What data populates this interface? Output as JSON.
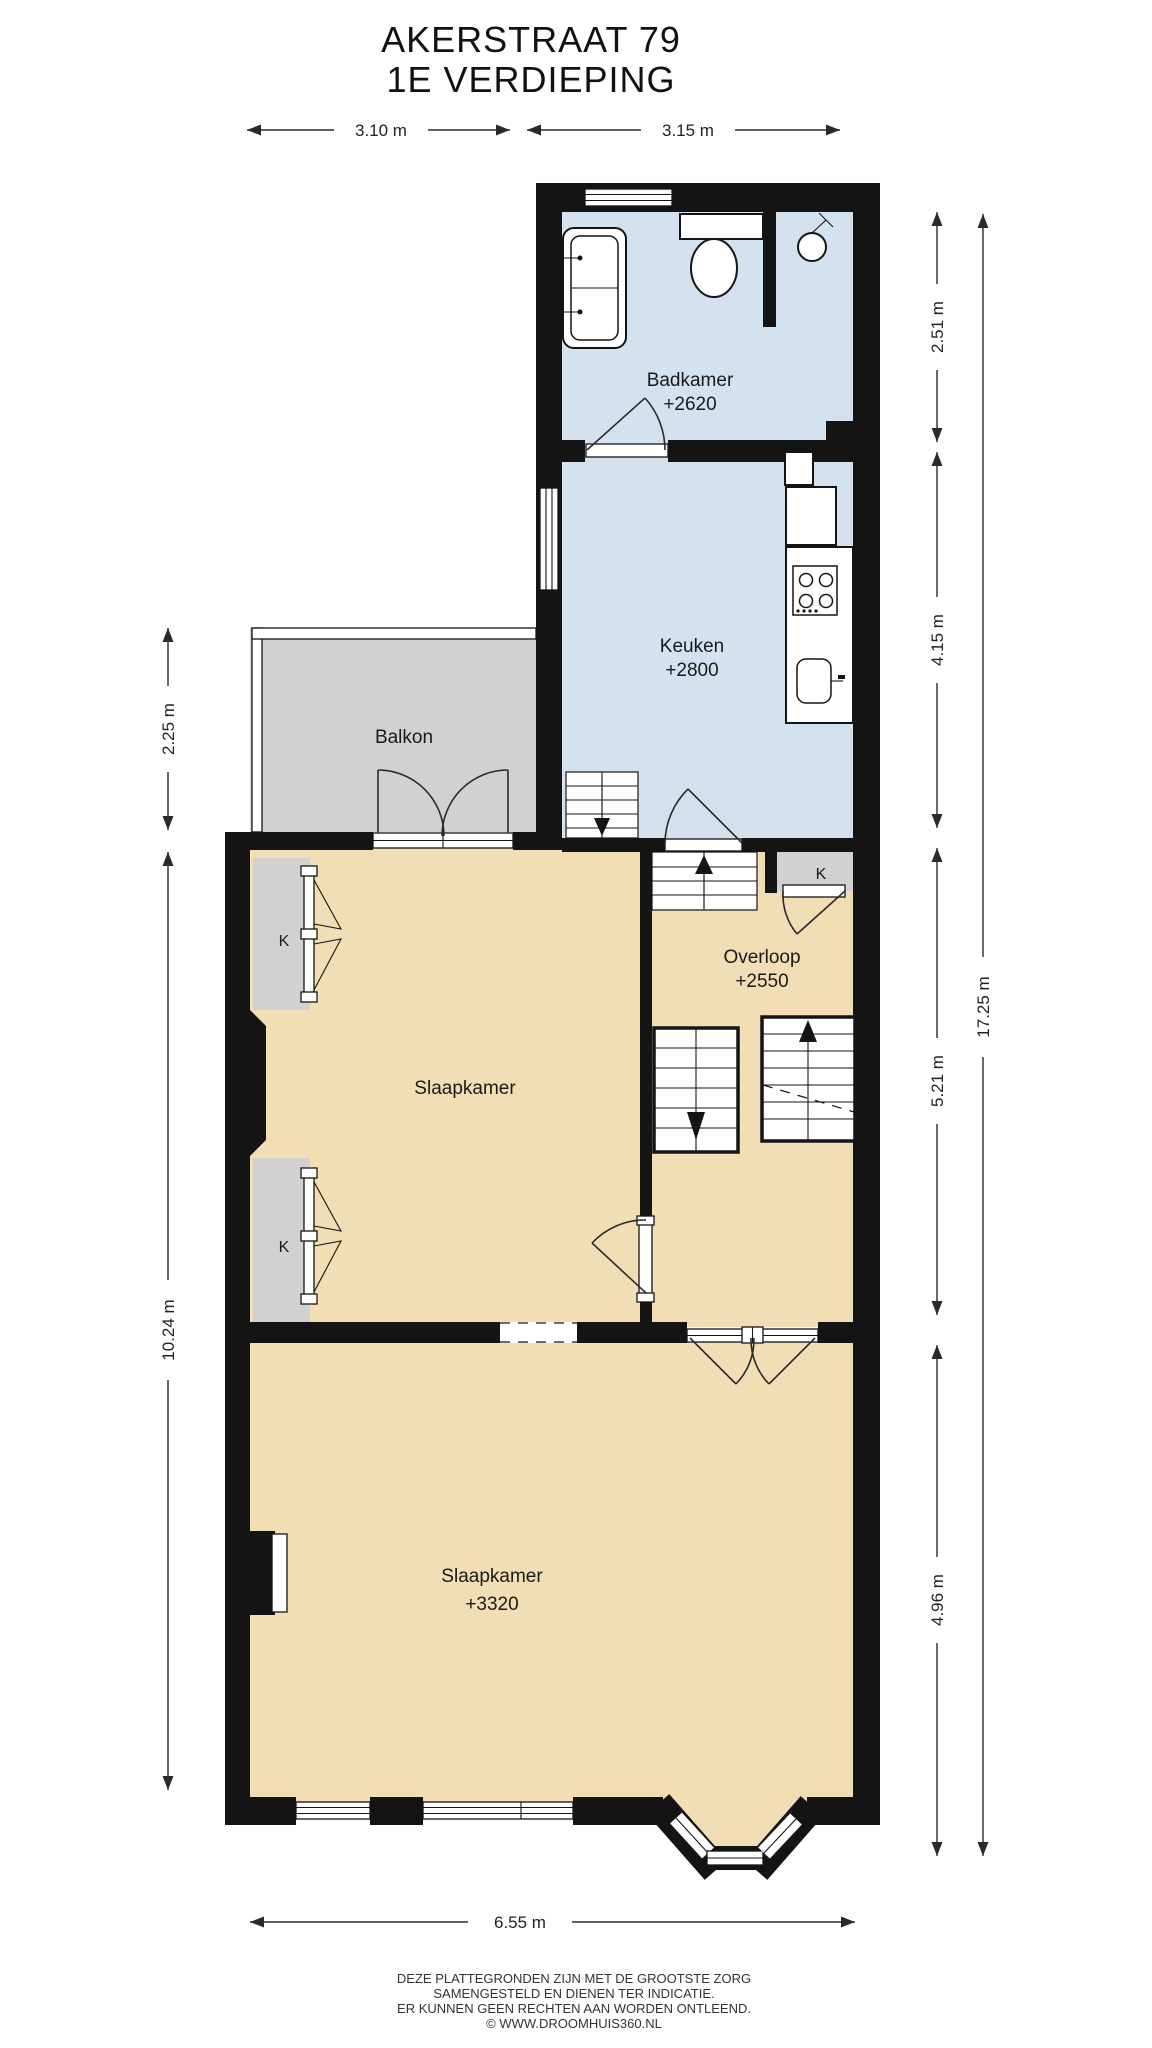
{
  "title": {
    "line1": "AKERSTRAAT 79",
    "line2": "1E VERDIEPING"
  },
  "rooms": {
    "badkamer": {
      "name": "Badkamer",
      "level": "+2620"
    },
    "keuken": {
      "name": "Keuken",
      "level": "+2800"
    },
    "balkon": {
      "name": "Balkon"
    },
    "slaapkamer_mid": {
      "name": "Slaapkamer"
    },
    "overloop": {
      "name": "Overloop",
      "level": "+2550"
    },
    "slaapkamer_front": {
      "name": "Slaapkamer",
      "level": "+3320"
    },
    "closet": {
      "label": "K"
    }
  },
  "dimensions": {
    "top_left": "3.10 m",
    "top_right": "3.15 m",
    "right_badkamer": "2.51 m",
    "right_keuken": "4.15 m",
    "right_overloop": "5.21 m",
    "right_slaapkamer": "4.96 m",
    "right_total": "17.25 m",
    "left_balkon": "2.25 m",
    "left_slaapkamers": "10.24 m",
    "bottom": "6.55 m"
  },
  "footer": {
    "line1": "DEZE PLATTEGRONDEN ZIJN MET DE GROOTSTE ZORG",
    "line2": "SAMENGESTELD EN DIENEN TER INDICATIE.",
    "line3": "ER KUNNEN GEEN RECHTEN AAN WORDEN ONTLEEND.",
    "line4": "© WWW.DROOMHUIS360.NL"
  },
  "colors": {
    "wall": "#141414",
    "wet_room_floor": "#d4e2ef",
    "bedroom_floor": "#f3ddb4",
    "balcony_closet": "#d1d1d1",
    "background": "#ffffff"
  }
}
